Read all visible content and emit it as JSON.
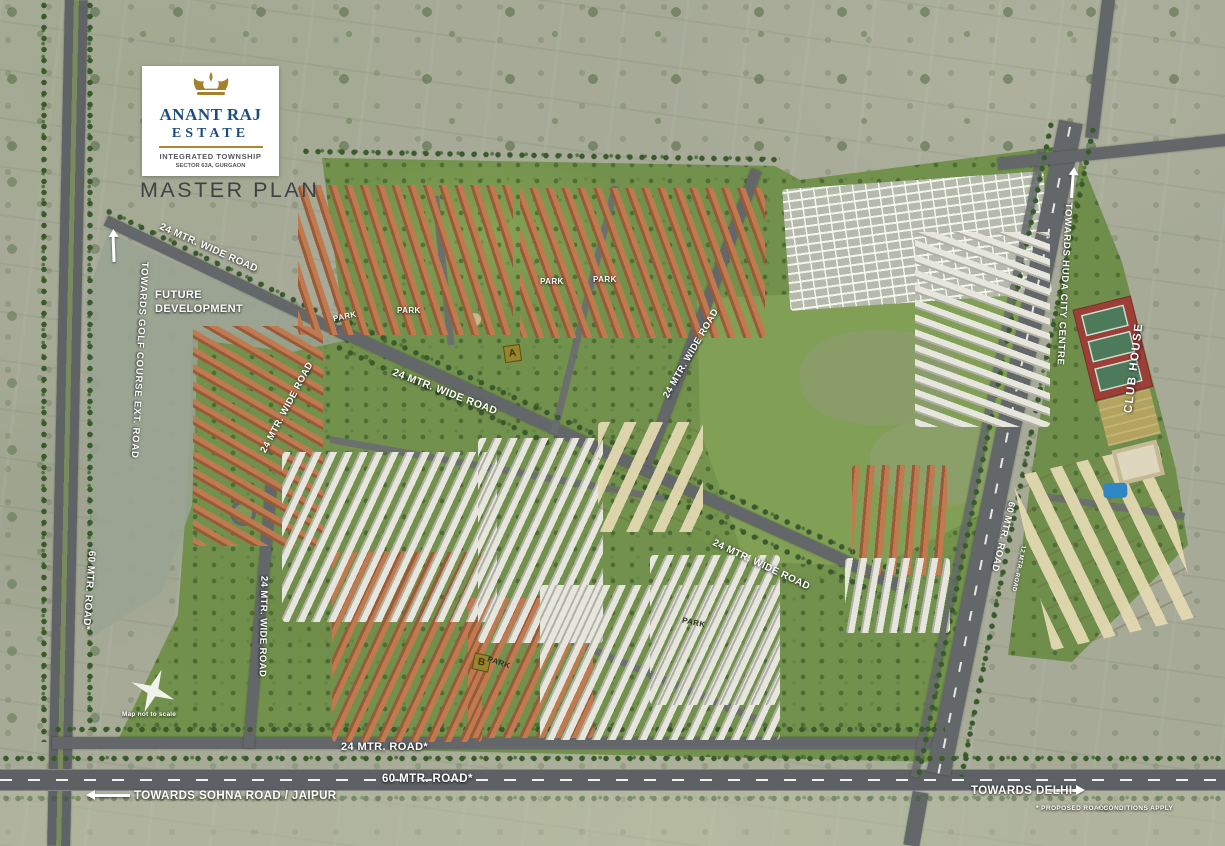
{
  "app": {
    "name": "Anant Raj Estate Master Plan"
  },
  "logo": {
    "brand_line1": "ANANT RAJ",
    "brand_line2": "ESTATE",
    "subtitle1": "INTEGRATED TOWNSHIP",
    "subtitle2": "SECTOR 63A, GURGAON"
  },
  "title": {
    "master_plan": "MASTER PLAN"
  },
  "areas": {
    "future_development": "FUTURE DEVELOPMENT",
    "club_house": "CLUB HOUSE",
    "park": "PARK",
    "block_a": "A",
    "block_b": "B"
  },
  "roads": {
    "wide_road_24": "24 MTR. WIDE ROAD",
    "road_24_proposed": "24 MTR. ROAD*",
    "road_60_proposed": "60 MTR. ROAD*",
    "road_60": "60 MTR. ROAD",
    "road_12": "12 MTR. ROAD",
    "towards_golf_course": "TOWARDS GOLF COURSE EXT. ROAD",
    "towards_huda_city_centre": "TOWARDS HUDA CITY CENTRE",
    "towards_sohna_jaipur": "TOWARDS SOHNA ROAD / JAIPUR",
    "towards_delhi": "TOWARDS DELHI"
  },
  "notes": {
    "scale": "Map not to scale",
    "proposed": "* PROPOSED ROADS",
    "conditions": "+ CONDITIONS APPLY"
  },
  "colors": {
    "brand_navy": "#1c4d7d",
    "brand_gold": "#ab8733",
    "road_gray": "#63676a",
    "township_green": "#72914c",
    "club_red": "#9b3f37",
    "marker_olive": "#97852c"
  }
}
